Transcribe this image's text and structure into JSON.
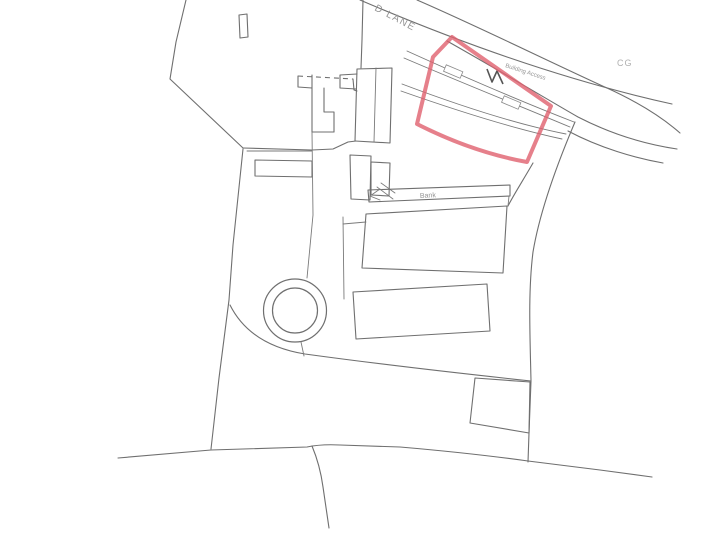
{
  "plan": {
    "labels": {
      "road": "D LANE",
      "area_code": "CG",
      "building_access": "Building Access",
      "bank": "Bank"
    },
    "colors": {
      "plot_outline": "#e0606e",
      "drawing_lines": "#6f6f6f",
      "label_text": "#949494",
      "background": "#ffffff"
    }
  }
}
